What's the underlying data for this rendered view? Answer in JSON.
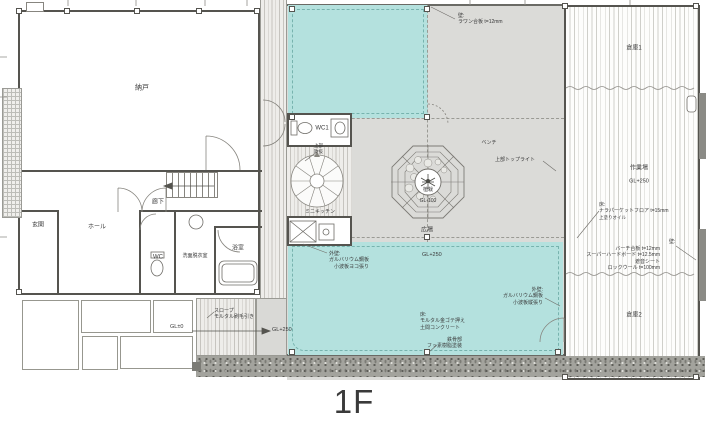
{
  "title": "1F",
  "colors": {
    "highlight": "#b4e1de",
    "court_gray": "#dbdbd8",
    "wall": "#55544f"
  },
  "rooms": {
    "storage": "納戸",
    "entrance": "玄関",
    "hall": "ホール",
    "corridor": "廊下",
    "wc": "WC",
    "washroom": "洗面脱衣室",
    "bathroom": "浴室",
    "wc1": "WC1",
    "mini_kitchen": "ミニキッチン",
    "warehouse1": "倉庫1",
    "workshop": "作業場",
    "warehouse2": "倉庫2",
    "plaza": "広場",
    "planting": "植栽",
    "bench": "ベンチ"
  },
  "levels": {
    "gl_zero": "GL±0",
    "gl_plus250_slope": "GL+250",
    "gl_plus250_plaza": "GL+250",
    "gl_plus250_workshop": "GL+250",
    "gl_minus100": "GL-100"
  },
  "annotations": {
    "wall_lauan": [
      "壁:",
      "ラワン合板 t=12mm"
    ],
    "toplight_above": "上部トップライト",
    "void_above": [
      "上部",
      "吹抜"
    ],
    "floor_parquet": [
      "床:",
      "ナラパーケットフロア t=15mm",
      "上塗りオイル"
    ],
    "wall_birch": [
      "壁:",
      "バーチ合板 t=12mm",
      "スーパーハードボード t=12.5mm",
      "遮音シート",
      "ロックウール t=100mm"
    ],
    "extwall_vertical": [
      "外壁:",
      "ガルバリウム鋼板",
      "小波板縦張り"
    ],
    "extwall_horizontal": [
      "外壁:",
      "ガルバリウム鋼板",
      "小波板ヨコ張り"
    ],
    "floor_mortar": [
      "床:",
      "モルタル金ゴテ押え",
      "土間コンクリート"
    ],
    "steel_coating": [
      "鉄骨部",
      "フッ素樹脂塗装"
    ],
    "slope": [
      "スロープ",
      "モルタル刷毛引き"
    ]
  }
}
